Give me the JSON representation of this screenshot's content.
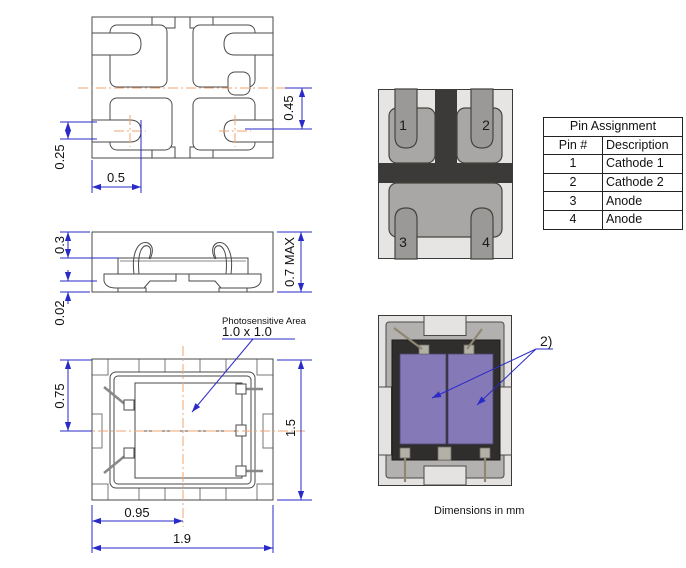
{
  "views": {
    "top": {
      "dim_right": "0.45",
      "dim_left": "0.25",
      "dim_bottom": "0.5"
    },
    "side": {
      "dim_top": "0.3",
      "dim_bottom": "0.02",
      "dim_right": "0.7 MAX"
    },
    "bottom": {
      "dim_left": "0.75",
      "dim_right": "1.5",
      "dim_inner": "0.95",
      "dim_outer": "1.9",
      "photo_line1": "Photosensitive Area",
      "photo_line2": "1.0 x 1.0"
    },
    "package_bottom": {
      "pins": [
        "1",
        "2",
        "3",
        "4"
      ]
    },
    "package_top": {
      "note": "2)"
    }
  },
  "pin_table": {
    "title": "Pin Assignment",
    "col_pin": "Pin #",
    "col_desc": "Description",
    "rows": [
      {
        "pin": "1",
        "desc": "Cathode 1"
      },
      {
        "pin": "2",
        "desc": "Cathode 2"
      },
      {
        "pin": "3",
        "desc": "Anode"
      },
      {
        "pin": "4",
        "desc": "Anode"
      }
    ]
  },
  "footer": {
    "note": "Dimensions in mm"
  },
  "colors": {
    "dimension_blue": "#2a2ac8",
    "centerline_orange": "#f0a56e",
    "photosensitive_purple": "#8579b7",
    "package_body": "#e4e3e1",
    "pad_gray": "#a9a7a5",
    "dark_mold": "#3b3a39"
  }
}
